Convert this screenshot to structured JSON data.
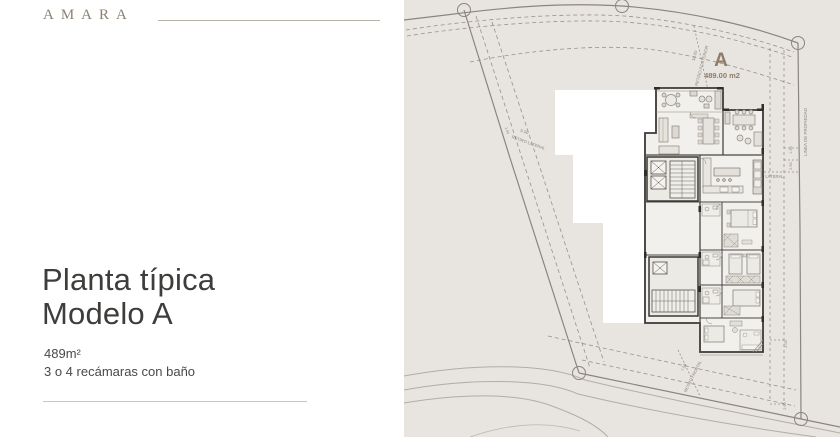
{
  "brand": {
    "name": "AMARA"
  },
  "panel": {
    "title_line1": "Planta típica",
    "title_line2": "Modelo A",
    "area": "489m²",
    "bedrooms": "3 o 4 recámaras con baño"
  },
  "site_plan": {
    "unit": {
      "label": "A",
      "area": "489.00 m2"
    },
    "annotations": {
      "posterior_dim": "10.00",
      "posterior": "RETIRO POSTERIOR",
      "property_line": "LINEA DE PROPIEDAD",
      "lateral_left_dim": "6.00",
      "lateral_left": "RETIRO LATERAL",
      "lateral_right_dim": "4.08",
      "lateral_right": "RETIRO LATERAL",
      "frontal_dim": "7.50",
      "frontal": "RETIRO FRONTAL",
      "dim_150": "1.50",
      "dim_250": "2.50",
      "dim_200": "2.00"
    },
    "colors": {
      "background": "#e8e4df",
      "accent": "#8f7c6a",
      "line": "#8a857e",
      "wall": "#3b3835",
      "footprint": "#ffffff"
    }
  }
}
